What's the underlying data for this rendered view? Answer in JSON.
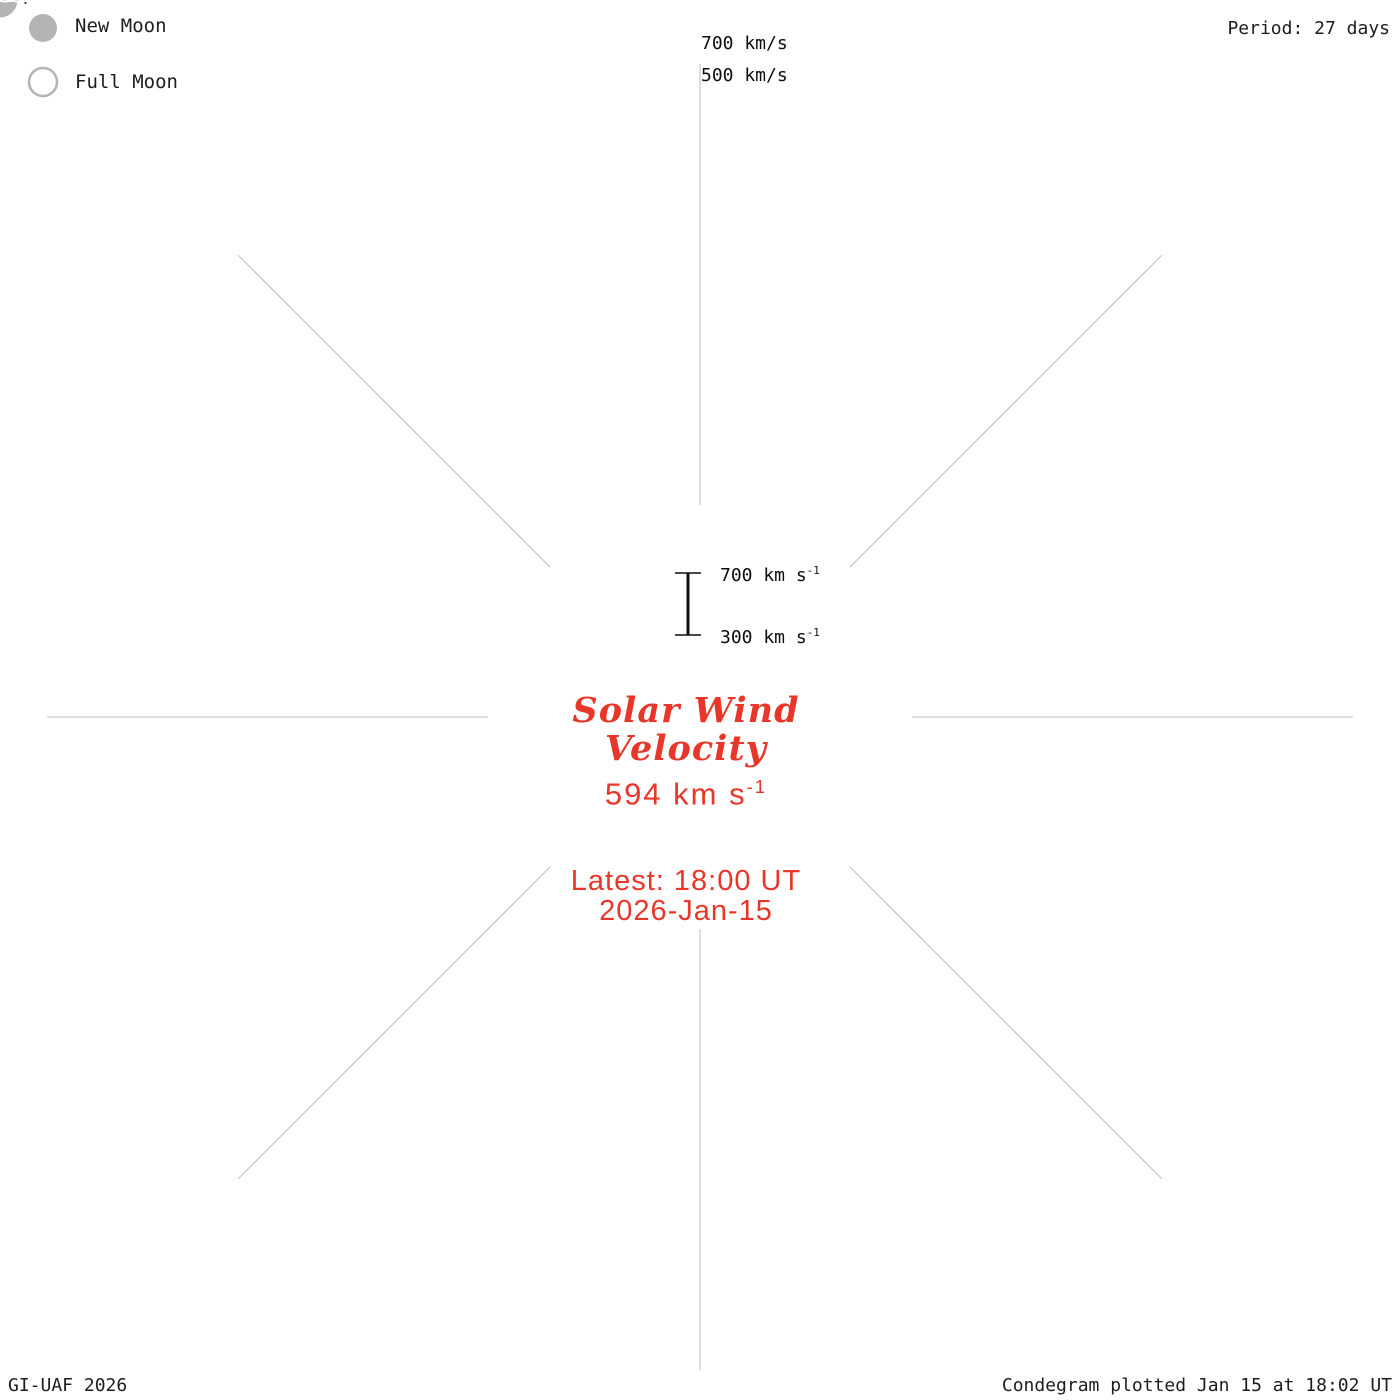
{
  "header": {
    "period_label": "Period: 27 days"
  },
  "legend": {
    "new_label": "New Moon",
    "full_label": "Full Moon"
  },
  "velocity_axis": {
    "outer_label": "700 km/s",
    "inner_label": "500 km/s"
  },
  "scale_bar": {
    "top": "700 km s",
    "top_exp": "-1",
    "bottom": "300 km s",
    "bottom_exp": "-1"
  },
  "center": {
    "title1": "Solar Wind",
    "title2": "Velocity",
    "value": "594 km s",
    "value_exp": "-1",
    "latest": "Latest: 18:00 UT",
    "date": "2026-Jan-15"
  },
  "footer": {
    "left": "GI-UAF 2026",
    "right": "Condegram plotted Jan 15 at 18:02 UT"
  },
  "chart_data": {
    "type": "area",
    "layout": "spiral-polar-condegram",
    "title": "Solar Wind Velocity",
    "latest_value_kms": 594,
    "latest_time": "2026-Jan-15 18:00 UT",
    "period_days": 27,
    "radial_axis": {
      "label": "km/s",
      "min": 300,
      "max": 700,
      "gridline_step": 100
    },
    "day0_date_at_top": "03-Sep",
    "turn_dates_at_top": [
      "03-Sep",
      "30-Sep",
      "27-Oct",
      "23-Nov",
      "20-Dec",
      "16-Jan"
    ],
    "geometry": {
      "cx": 700,
      "cy": 717,
      "r0": 233,
      "turn_px": 69.5,
      "px_per_100": 17.4,
      "d_start": -3.8,
      "d_end": 134.75,
      "grid_d_end": 162,
      "v_base": 300,
      "v_top": 700,
      "radial_r_in": 212,
      "radial_r_out": 653,
      "n_radials": 8
    },
    "colors": {
      "grid": "#c6c6c6",
      "radial": "#bdbdbd",
      "moon": "#b4b4b4",
      "edge": "#050505",
      "label_text": "#2e2e2e",
      "annotation_red": "#e8372a"
    },
    "color_stops": [
      [
        -3.8,
        "#1c1468"
      ],
      [
        5,
        "#241c84"
      ],
      [
        12,
        "#2a24a0"
      ],
      [
        20,
        "#2c30b4"
      ],
      [
        24,
        "#2e3ec4"
      ],
      [
        30,
        "#3050c8"
      ],
      [
        36,
        "#3a64c8"
      ],
      [
        42,
        "#4478c6"
      ],
      [
        46,
        "#418cc2"
      ],
      [
        49,
        "#3da0b2"
      ],
      [
        54,
        "#3eb49e"
      ],
      [
        60,
        "#3dbf92"
      ],
      [
        66,
        "#3eca80"
      ],
      [
        72,
        "#42cb68"
      ],
      [
        76,
        "#48c852"
      ],
      [
        81,
        "#55c035"
      ],
      [
        87,
        "#7cc433"
      ],
      [
        90,
        "#8cc22c"
      ],
      [
        93,
        "#a4bb22"
      ],
      [
        99,
        "#aeb220"
      ],
      [
        102,
        "#b2a91d"
      ],
      [
        105,
        "#b49c15"
      ],
      [
        108,
        "#b8860b"
      ],
      [
        112,
        "#b1780f"
      ],
      [
        116,
        "#b56c0e"
      ],
      [
        119,
        "#bd5f10"
      ],
      [
        121,
        "#c85713"
      ],
      [
        123,
        "#c04814"
      ],
      [
        126,
        "#c23a12"
      ],
      [
        129,
        "#c62b13"
      ],
      [
        134.75,
        "#cc1210"
      ]
    ],
    "envelope_points": [
      [
        -3.8,
        355
      ],
      [
        -2.6,
        375
      ],
      [
        -2.1,
        390
      ],
      [
        -1.7,
        660
      ],
      [
        -1.2,
        700
      ],
      [
        -0.4,
        690
      ],
      [
        0.2,
        655
      ],
      [
        0.8,
        575
      ],
      [
        1.6,
        505
      ],
      [
        2.6,
        470
      ],
      [
        3.8,
        440
      ],
      [
        5,
        455
      ],
      [
        6,
        425
      ],
      [
        7.5,
        465
      ],
      [
        9,
        435
      ],
      [
        10.5,
        415
      ],
      [
        12,
        445
      ],
      [
        13.5,
        435
      ],
      [
        15,
        455
      ],
      [
        16.2,
        505
      ],
      [
        16.9,
        430
      ],
      [
        18,
        385
      ],
      [
        19.5,
        395
      ],
      [
        21,
        425
      ],
      [
        22.5,
        475
      ],
      [
        24,
        505
      ],
      [
        25.5,
        485
      ],
      [
        27,
        465
      ],
      [
        28.5,
        445
      ],
      [
        30,
        485
      ],
      [
        31.5,
        465
      ],
      [
        33,
        445
      ],
      [
        34.5,
        485
      ],
      [
        36,
        520
      ],
      [
        37.5,
        545
      ],
      [
        39,
        530
      ],
      [
        40.5,
        550
      ],
      [
        42,
        560
      ],
      [
        43.5,
        540
      ],
      [
        45,
        505
      ],
      [
        46.5,
        465
      ],
      [
        48,
        440
      ],
      [
        49.5,
        485
      ],
      [
        51,
        535
      ],
      [
        52.5,
        565
      ],
      [
        54,
        545
      ],
      [
        55.5,
        565
      ],
      [
        57,
        585
      ],
      [
        58.5,
        605
      ],
      [
        60,
        595
      ],
      [
        61.5,
        575
      ],
      [
        63,
        560
      ],
      [
        64.5,
        545
      ],
      [
        66,
        575
      ],
      [
        67.5,
        560
      ],
      [
        69,
        545
      ],
      [
        70.5,
        505
      ],
      [
        72,
        565
      ],
      [
        73,
        605
      ],
      [
        74,
        565
      ],
      [
        75.5,
        425
      ],
      [
        77,
        395
      ],
      [
        78.5,
        375
      ],
      [
        80,
        395
      ],
      [
        81,
        425
      ],
      [
        82.5,
        475
      ],
      [
        84,
        515
      ],
      [
        85.5,
        565
      ],
      [
        87,
        585
      ],
      [
        88.5,
        565
      ],
      [
        90,
        545
      ],
      [
        91.5,
        505
      ],
      [
        93,
        535
      ],
      [
        94.5,
        485
      ],
      [
        96,
        455
      ],
      [
        97.5,
        435
      ],
      [
        99,
        425
      ],
      [
        100.5,
        445
      ],
      [
        102,
        435
      ],
      [
        103.5,
        425
      ],
      [
        105,
        415
      ],
      [
        106.5,
        405
      ],
      [
        108,
        435
      ],
      [
        109.5,
        475
      ],
      [
        111,
        495
      ],
      [
        112.5,
        475
      ],
      [
        114,
        465
      ],
      [
        115.5,
        445
      ],
      [
        117,
        435
      ],
      [
        118.5,
        455
      ],
      [
        120,
        495
      ],
      [
        121.5,
        525
      ],
      [
        123,
        535
      ],
      [
        124,
        485
      ],
      [
        125,
        425
      ],
      [
        126,
        395
      ],
      [
        127.5,
        375
      ],
      [
        129,
        405
      ],
      [
        130.5,
        455
      ],
      [
        132,
        525
      ],
      [
        133,
        565
      ],
      [
        134,
        585
      ],
      [
        134.75,
        594
      ]
    ],
    "data_gaps": [
      [
        39.4,
        39.55
      ],
      [
        40.3,
        40.55
      ],
      [
        61.3,
        61.45
      ],
      [
        71.8,
        71.95
      ],
      [
        74.6,
        75.3
      ],
      [
        78.8,
        79.05
      ],
      [
        85.8,
        86.6
      ],
      [
        103.3,
        103.45
      ],
      [
        105.6,
        105.75
      ],
      [
        106.4,
        106.55
      ],
      [
        109.4,
        109.6
      ],
      [
        112.2,
        112.4
      ],
      [
        115.1,
        115.3
      ],
      [
        116.1,
        116.5
      ],
      [
        117.6,
        117.8
      ],
      [
        118.6,
        119.0
      ],
      [
        122.4,
        122.6
      ],
      [
        123.1,
        123.3
      ],
      [
        126.4,
        126.6
      ],
      [
        128.1,
        128.3
      ],
      [
        130.0,
        130.2
      ],
      [
        131.4,
        131.6
      ]
    ],
    "date_labels": [
      [
        0,
        "03-Sep"
      ],
      [
        3,
        "06-Sep"
      ],
      [
        6,
        "09-Sep"
      ],
      [
        9,
        "12-Sep"
      ],
      [
        12,
        "15-Sep"
      ],
      [
        15,
        "18-Sep"
      ],
      [
        18,
        "21-Sep"
      ],
      [
        21,
        "24-Sep"
      ],
      [
        24,
        "27-Sep"
      ],
      [
        27,
        "30-Sep"
      ],
      [
        30,
        "03-Oct"
      ],
      [
        33,
        "06-Oct"
      ],
      [
        36,
        "09-Oct"
      ],
      [
        39,
        "12-Oct"
      ],
      [
        42,
        "15-Oct"
      ],
      [
        45,
        "18-Oct"
      ],
      [
        48,
        "21-Oct"
      ],
      [
        51,
        "24-Oct"
      ],
      [
        54,
        "27-Oct"
      ],
      [
        57,
        "30-Oct"
      ],
      [
        60,
        "02-Nov"
      ],
      [
        63,
        "05-Nov"
      ],
      [
        66,
        "08-Nov"
      ],
      [
        69,
        "11-Nov"
      ],
      [
        72,
        "14-Nov"
      ],
      [
        75,
        "17-Nov"
      ],
      [
        78,
        "20-Nov"
      ],
      [
        81,
        "23-Nov"
      ],
      [
        84,
        "26-Nov"
      ],
      [
        87,
        "29-Nov"
      ],
      [
        90,
        "02-Dec"
      ],
      [
        93,
        "05-Dec"
      ],
      [
        96,
        "08-Dec"
      ],
      [
        99,
        "11-Dec"
      ],
      [
        102,
        "14-Dec"
      ],
      [
        105,
        "17-Dec"
      ],
      [
        108,
        "20-Dec"
      ],
      [
        111,
        "23-Dec"
      ],
      [
        114,
        "26-Dec"
      ],
      [
        117,
        "29-Dec"
      ],
      [
        120,
        "01-Jan"
      ],
      [
        123,
        "04-Jan"
      ],
      [
        126,
        "07-Jan"
      ],
      [
        129,
        "10-Jan"
      ],
      [
        132,
        "13-Jan"
      ]
    ],
    "label_rotations": {
      "0": 8,
      "40": 44,
      "80": 84,
      "120": -40,
      "160": -4,
      "200": 30,
      "240": 62,
      "280": -62,
      "320": -30
    },
    "moons": [
      {
        "type": "full",
        "date": "07-Sep",
        "d": 4.5,
        "dr": 30
      },
      {
        "type": "new",
        "date": "21-Sep",
        "d": 18.8,
        "dr": 57
      },
      {
        "type": "full",
        "date": "07-Oct",
        "d": 34.3,
        "dr": 33
      },
      {
        "type": "new",
        "date": "21-Oct",
        "d": 48.3,
        "dr": 45
      },
      {
        "type": "full",
        "date": "05-Nov",
        "d": 63.3,
        "dr": 42
      },
      {
        "type": "new",
        "date": "20-Nov",
        "d": 78.3,
        "dr": 33
      },
      {
        "type": "full",
        "date": "05-Dec",
        "d": 93.3,
        "dr": 52
      },
      {
        "type": "new",
        "date": "20-Dec",
        "d": 108.4,
        "dr": 19
      },
      {
        "type": "full",
        "date": "03-Jan",
        "d": 122.3,
        "dr": 56
      }
    ]
  }
}
